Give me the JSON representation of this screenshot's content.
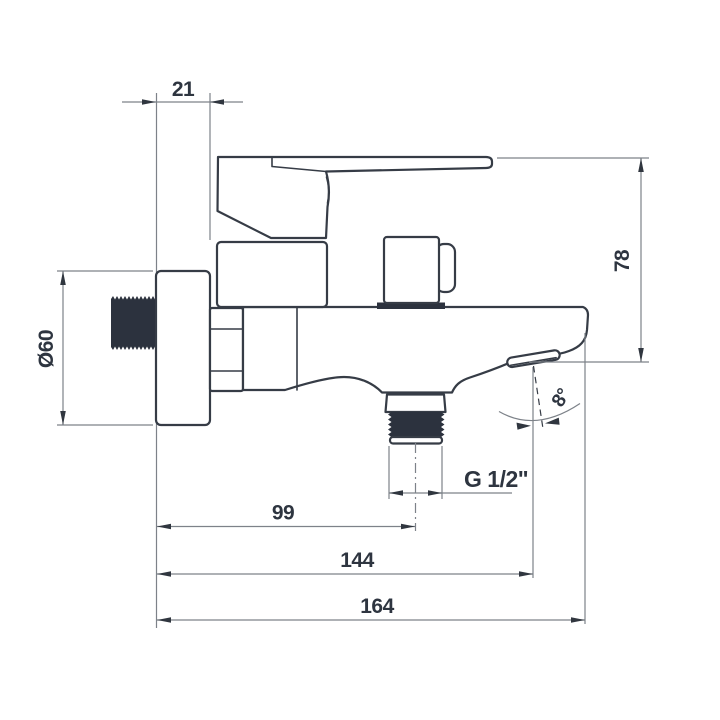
{
  "diagram": {
    "type": "engineering-dimension-drawing",
    "subject": "Wall-mounted single-lever bath mixer tap, side elevation with dimensions",
    "colors": {
      "outline": "#363c46",
      "dimension_lines": "#7d8289",
      "text": "#2e3540",
      "dark_fill": "#2c323e",
      "background": "#ffffff"
    },
    "dims": {
      "wall_offset": {
        "label": "21",
        "value": 21
      },
      "flange_diameter": {
        "label": "Ø60",
        "value": 60
      },
      "drop_height": {
        "label": "78",
        "value": 78
      },
      "spray_angle": {
        "label": "8°",
        "value": 8
      },
      "outlet_thread": {
        "label": "G 1/2\""
      },
      "reach_to_outlet": {
        "label": "99",
        "value": 99
      },
      "reach_to_spout": {
        "label": "144",
        "value": 144
      },
      "total_reach": {
        "label": "164",
        "value": 164
      }
    }
  }
}
